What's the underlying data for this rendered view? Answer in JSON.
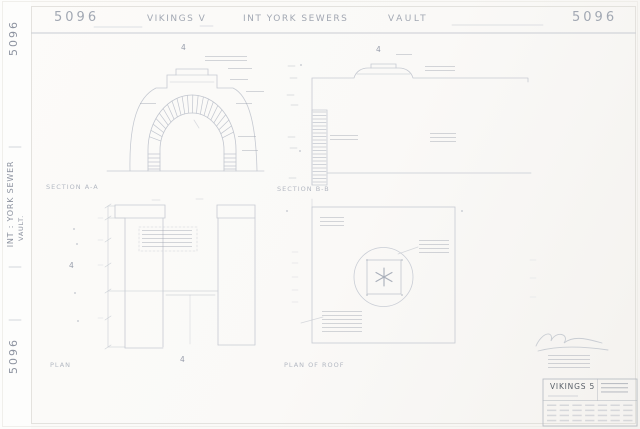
{
  "header": {
    "number_left": "5096",
    "production": "VIKINGS V",
    "scene": "INT YORK SEWERS",
    "subject": "VAULT",
    "number_right": "5096"
  },
  "margin": {
    "number_top": "5096",
    "title": "INT : YORK SEWER",
    "subtitle": "VAULT.",
    "number_bottom": "5096"
  },
  "labels": {
    "section_a": "SECTION A-A",
    "section_b": "SECTION B-B",
    "plan_left": "PLAN",
    "plan_right": "PLAN OF ROOF",
    "grid_marker": "4"
  },
  "title_block": {
    "production": "VIKINGS 5"
  },
  "colors": {
    "pencil_line": "#c6cad2",
    "pencil_text": "#a2a8b3",
    "paper": "#faf9f7"
  }
}
